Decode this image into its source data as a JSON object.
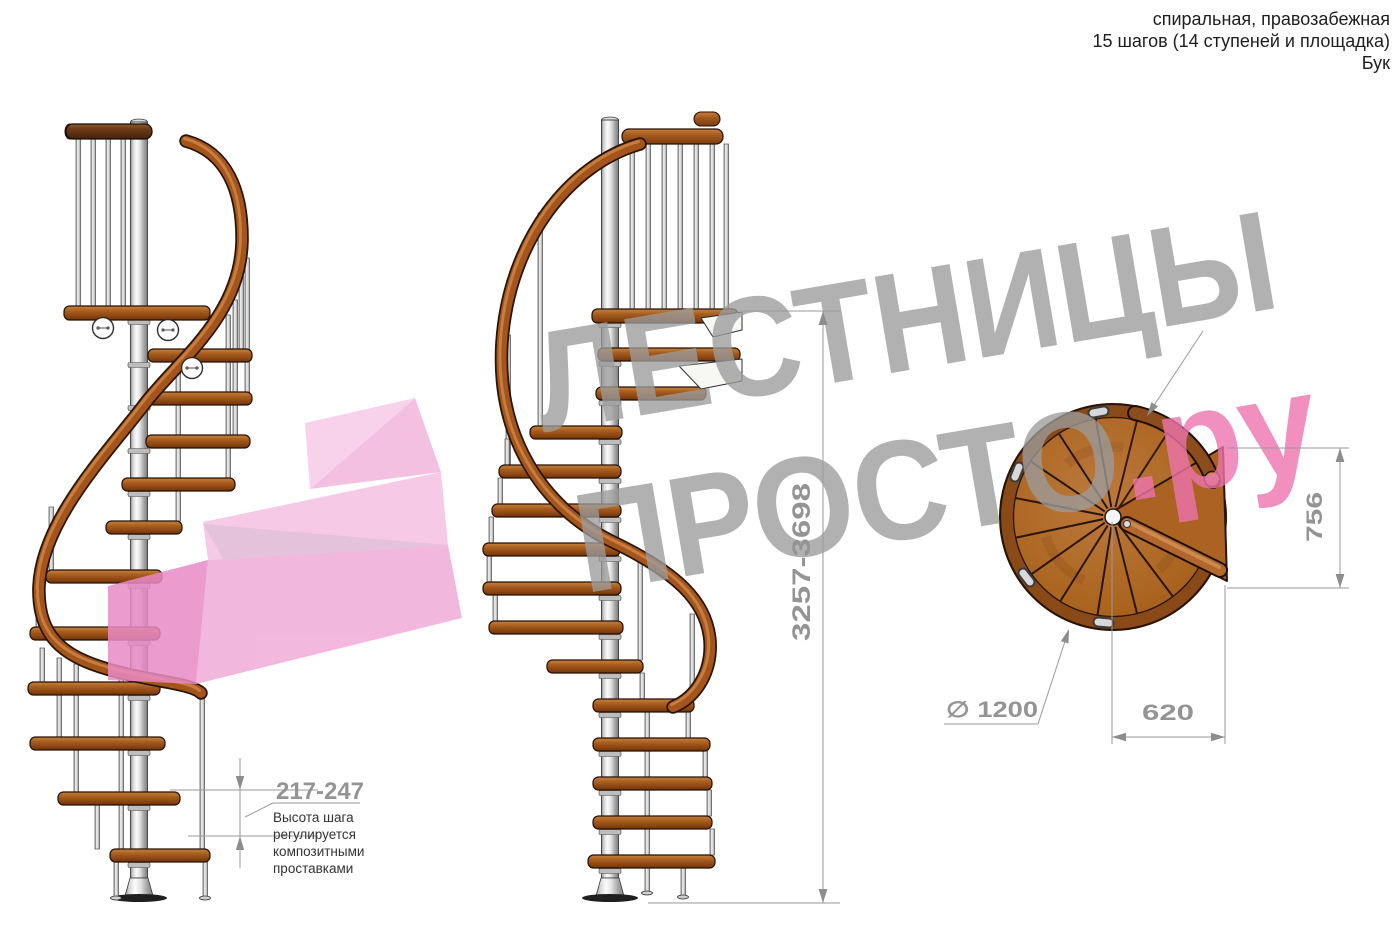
{
  "header": {
    "line1": "спиральная, правозабежная",
    "line2": "15 шагов (14 ступеней и площадка)",
    "line3": "Бук"
  },
  "watermark": {
    "brand_line1": "ЛЕСТНИЦЫ",
    "brand_line2": "ПРОСТО",
    "brand_suffix": ".ру",
    "gray": "#9b9b9b",
    "pink": "#ee74ae"
  },
  "dimensions": {
    "total_height": "3257-3698",
    "step_height": "217-247",
    "landing_depth": "756",
    "landing_width": "620",
    "diameter": "∅ 1200"
  },
  "note": {
    "lines": [
      "Высота шага",
      "регулируется",
      "композитными",
      "проставками"
    ]
  },
  "colors": {
    "wood": "#a8601f",
    "wood_dark": "#7a3a10",
    "rail": "#a3551b",
    "metal": "#cfcfcf",
    "dimension_gray": "#949494",
    "logo_pink": "#f3b6de"
  }
}
